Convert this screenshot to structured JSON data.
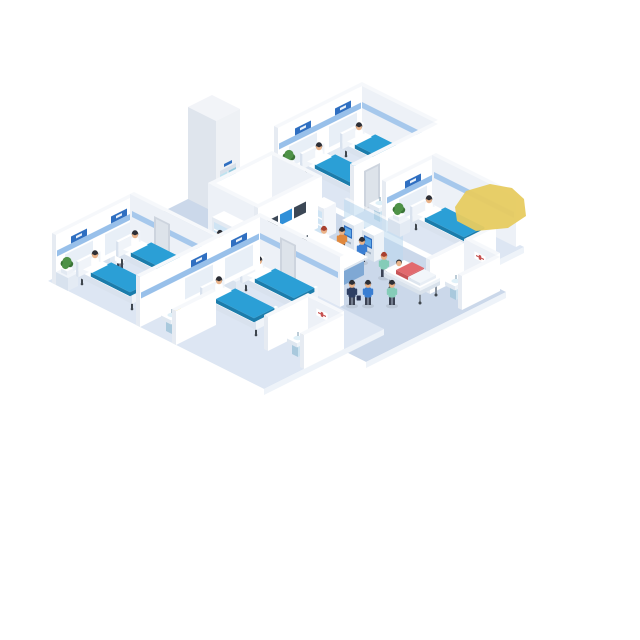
{
  "scene": {
    "title": "Isometric hospital ward illustration",
    "description": "Dollhouse-view hospital floor: four patient wards with blue beds and sitting patients, a single-bed ward, nurse reception desk with sign, control wall with monitors, elevator, two self-service kiosks with users, a stretcher pushed by a nurse, four small bathrooms with sinks and toilets, plants on bedside tables, and a yellow highlight marker at the upper right."
  },
  "labels": {
    "desk_sign": "护士站"
  },
  "colors": {
    "floor_room": "#dde6f3",
    "floor_corridor": "#cbd8ea",
    "floor_sw": "#ffffff",
    "floor_se": "#eef3f9",
    "wall_top": "#f6f8fb",
    "wall_sw": "#e6ebf2",
    "wall_se": "#ffffff",
    "wall_inner": "#edf1f7",
    "stripe": "#8db9e8",
    "sign": "#2f6fc1",
    "panel": "#e8eff7",
    "door": "#cdd4de",
    "door_inner": "#dde3ea",
    "bed_top": "#2b9fd6",
    "bed_side": "#1b7cab",
    "frame": "#ffffff",
    "frame_side": "#d9e2ee",
    "leg": "#3f464e",
    "pillow": "#ffffff",
    "table": "#f1f5fa",
    "table_side": "#d8e2ee",
    "pot": "#ffffff",
    "plant": "#4e9247",
    "plant_dark": "#3a7336",
    "desk_band": "#1d5ca8",
    "desk_body": "#a9c9e8",
    "desk_side": "#7fa8d4",
    "desk_top": "#ffffff",
    "glass": "#bcd9ee",
    "kiosk_body": "#eef3f8",
    "kiosk_side": "#d7e1ec",
    "kiosk_screen": "#2f6fc1",
    "monitor_dark": "#3c4856",
    "monitor_blue": "#2f8fd8",
    "monitor_frame": "#ffffff",
    "cab_glass": "#cfe4f4",
    "elev_top": "#f2f4f8",
    "elev_sw": "#dfe5ed",
    "elev_se": "#eef1f5",
    "elev_door": "#bfe2ef",
    "elev_door2": "#93c9de",
    "elev_lintel": "#d8e0ea",
    "gurney": "#f4f7fa",
    "gurney_side": "#d9e2ec",
    "sink": "#cde3f0",
    "sink_side": "#a9c9dd",
    "basin": "#dff0f8",
    "toilet": "#ffffff",
    "toilet_seat": "#e7c444",
    "skin": "#eab389",
    "hair_dark": "#2d2f36",
    "hair_red": "#a8402f",
    "outfit_white": "#ffffff",
    "outfit_blue": "#3a7ed2",
    "outfit_green": "#85ccb8",
    "outfit_orange": "#e0883d",
    "outfit_navy": "#2e3f63",
    "outfit_pink": "#e26a6e",
    "pants": "#3c4354",
    "art_red": "#c65050",
    "yellow": "#e7cb60"
  },
  "objects": [
    {
      "t": "floor",
      "n": "floor-corridor",
      "p": [
        -95,
        -25
      ],
      "q": [
        -6,
        120
      ],
      "tone": "corridor"
    },
    {
      "t": "floor",
      "n": "floor-ward-r1",
      "p": [
        -25,
        19
      ],
      "q": [
        0,
        44
      ],
      "tone": "room"
    },
    {
      "t": "floor",
      "n": "floor-ward-r2",
      "p": [
        -25,
        2
      ],
      "q": [
        44,
        102
      ],
      "tone": "room"
    },
    {
      "t": "floor",
      "n": "floor-ward-r3",
      "p": [
        -134,
        -95
      ],
      "q": [
        0,
        46
      ],
      "tone": "room"
    },
    {
      "t": "floor",
      "n": "floor-ward-r4",
      "p": [
        -134,
        -74
      ],
      "q": [
        46,
        108
      ],
      "tone": "room"
    },
    {
      "t": "wallQ",
      "n": "wall-r1-headboard",
      "p": [
        -25,
        17
      ],
      "q": 4,
      "h": 50,
      "stripe": true,
      "panels": [
        -12.5,
        7.5
      ],
      "signs": [
        -12.5,
        7.5
      ]
    },
    {
      "t": "wallP",
      "n": "wall-r1-side",
      "p": 17,
      "q": [
        4,
        42
      ],
      "h": 50,
      "stripe": true
    },
    {
      "t": "wallQ",
      "n": "wall-r1-partition",
      "p": [
        -25,
        17
      ],
      "q": 42,
      "h": 50,
      "door": [
        -20,
        -12
      ]
    },
    {
      "t": "wallP",
      "n": "wall-bath1-side",
      "p": -5,
      "q": [
        44,
        58
      ],
      "h": 34,
      "art": true
    },
    {
      "t": "wallQ",
      "n": "wall-r2-headboard",
      "p": [
        -25,
        0
      ],
      "q": 58,
      "h": 50,
      "stripe": true,
      "panels": [
        -11.5
      ],
      "signs": [
        -11.5
      ]
    },
    {
      "t": "wallP",
      "n": "wall-r2-side",
      "p": 0,
      "q": [
        58,
        100
      ],
      "h": 50,
      "stripe": true
    },
    {
      "t": "wallQ",
      "n": "wall-r2-end",
      "p": [
        -25,
        -12
      ],
      "q": 100,
      "h": 34
    },
    {
      "t": "wallQ",
      "n": "wall-bath2-back",
      "p": [
        -45,
        -28
      ],
      "q": 100,
      "h": 34
    },
    {
      "t": "wallP",
      "n": "wall-bath2-side",
      "p": -26,
      "q": [
        100,
        116
      ],
      "h": 34,
      "art": true
    },
    {
      "t": "wallQ",
      "n": "wall-bath2-front",
      "p": [
        -45,
        -26
      ],
      "q": 116,
      "h": 34
    },
    {
      "t": "wallQ",
      "n": "wall-control-back",
      "p": [
        -70,
        -40
      ],
      "q": 16,
      "h": 50
    },
    {
      "t": "wallP",
      "n": "wall-control-east",
      "p": -40,
      "q": [
        16,
        41
      ],
      "h": 50
    },
    {
      "t": "wallP",
      "n": "wall-control-west",
      "p": -70,
      "q": [
        16,
        41
      ],
      "h": 50
    },
    {
      "t": "wallQ",
      "n": "wall-control-monitors",
      "p": [
        -70,
        -40
      ],
      "q": 39,
      "h": 50,
      "monitors": true
    },
    {
      "t": "wallQ",
      "n": "wall-r3-headboard",
      "p": [
        -134,
        -95
      ],
      "q": 2,
      "h": 50,
      "stripe": true,
      "panels": [
        -122.5,
        -102.5
      ],
      "signs": [
        -122.5,
        -102.5
      ]
    },
    {
      "t": "wallP",
      "n": "wall-r3-side",
      "p": -95,
      "q": [
        2,
        44
      ],
      "h": 50,
      "stripe": true,
      "door": [
        14,
        22
      ]
    },
    {
      "t": "wallQ",
      "n": "wall-r4-headboard",
      "p": [
        -134,
        -74
      ],
      "q": 44,
      "h": 50,
      "stripe": true,
      "panels": [
        -104.5,
        -84.5
      ],
      "signs": [
        -104.5,
        -84.5
      ]
    },
    {
      "t": "wallP",
      "n": "wall-r4-side",
      "p": -74,
      "q": [
        44,
        86
      ],
      "h": 50,
      "stripe": true,
      "door": [
        56,
        64
      ]
    },
    {
      "t": "wallP",
      "n": "wall-bath3-side",
      "p": -114,
      "q": [
        46,
        62
      ],
      "h": 34,
      "art": true
    },
    {
      "t": "wallQ",
      "n": "wall-bath3-front",
      "p": [
        -134,
        -114
      ],
      "q": 62,
      "h": 34
    },
    {
      "t": "wallQ",
      "n": "wall-bath4-back",
      "p": [
        -114,
        -94
      ],
      "q": 88,
      "h": 34
    },
    {
      "t": "wallP",
      "n": "wall-bath4-side",
      "p": -94,
      "q": [
        88,
        106
      ],
      "h": 34,
      "art": true
    },
    {
      "t": "wallQ",
      "n": "wall-bath4-front",
      "p": [
        -114,
        -94
      ],
      "q": 106,
      "h": 34
    },
    {
      "t": "glass",
      "n": "wall-kiosk-glass",
      "p": -38,
      "q": [
        52,
        80
      ],
      "h": 38,
      "k": 90
    },
    {
      "t": "elevator",
      "n": "elevator",
      "p": [
        -58,
        -46
      ],
      "q": [
        -6,
        8
      ]
    },
    {
      "t": "cabinet",
      "n": "supply-cabinet",
      "p": [
        -76,
        -70
      ],
      "q": [
        24,
        34
      ],
      "k": 112
    },
    {
      "t": "cabinet",
      "n": "medicine-cabinet",
      "p": [
        -44,
        -38
      ],
      "q": [
        42,
        48
      ]
    },
    {
      "t": "desk",
      "n": "reception-desk",
      "p": [
        -68,
        -52
      ],
      "q": [
        50,
        76
      ]
    },
    {
      "t": "kiosk",
      "n": "self-service-kiosk-1",
      "p": [
        -43,
        -38
      ],
      "q": [
        56,
        62
      ]
    },
    {
      "t": "kiosk",
      "n": "self-service-kiosk-2",
      "p": [
        -43,
        -38
      ],
      "q": [
        66,
        72
      ]
    },
    {
      "t": "gurney",
      "n": "stretcher-bed",
      "p": [
        -54,
        -42
      ],
      "q": [
        86,
        106
      ]
    },
    {
      "t": "bed",
      "n": "bed-r1-a",
      "p": [
        -18,
        -7
      ],
      "q": [
        10,
        38
      ]
    },
    {
      "t": "bed",
      "n": "bed-r1-b",
      "p": [
        2,
        13
      ],
      "q": [
        10,
        38
      ]
    },
    {
      "t": "bed",
      "n": "bed-r2",
      "p": [
        -17,
        -6
      ],
      "q": [
        64,
        92
      ]
    },
    {
      "t": "bed",
      "n": "bed-r3-a",
      "p": [
        -128,
        -117
      ],
      "q": [
        8,
        36
      ]
    },
    {
      "t": "bed",
      "n": "bed-r3-b",
      "p": [
        -108,
        -97
      ],
      "q": [
        8,
        36
      ]
    },
    {
      "t": "bed",
      "n": "bed-r4-a",
      "p": [
        -110,
        -99
      ],
      "q": [
        52,
        80
      ]
    },
    {
      "t": "bed",
      "n": "bed-r4-b",
      "p": [
        -90,
        -79
      ],
      "q": [
        52,
        80
      ]
    },
    {
      "t": "plantTable",
      "n": "bedside-plant",
      "p": [
        -25,
        -20
      ],
      "q": [
        6,
        12
      ]
    },
    {
      "t": "plantTable",
      "n": "bedside-plant",
      "p": [
        -5,
        0
      ],
      "q": [
        6,
        12
      ]
    },
    {
      "t": "plantTable",
      "n": "bedside-plant",
      "p": [
        -24,
        -19
      ],
      "q": [
        60,
        66
      ]
    },
    {
      "t": "plantTable",
      "n": "bedside-plant",
      "p": [
        -134,
        -129
      ],
      "q": [
        4,
        10
      ]
    },
    {
      "t": "plantTable",
      "n": "bedside-plant",
      "p": [
        -113,
        -108
      ],
      "q": [
        4,
        10
      ]
    },
    {
      "t": "plantTable",
      "n": "bedside-plant",
      "p": [
        -114,
        -109
      ],
      "q": [
        48,
        54
      ]
    },
    {
      "t": "plantTable",
      "n": "bedside-plant",
      "p": [
        -94,
        -89
      ],
      "q": [
        48,
        54
      ]
    },
    {
      "t": "sink",
      "n": "sink",
      "at": [
        -20,
        52
      ]
    },
    {
      "t": "toilet",
      "n": "toilet",
      "at": [
        -11,
        47
      ]
    },
    {
      "t": "sink",
      "n": "sink",
      "at": [
        -40,
        110
      ]
    },
    {
      "t": "toilet",
      "n": "toilet",
      "at": [
        -33,
        105
      ]
    },
    {
      "t": "sink",
      "n": "sink",
      "at": [
        -128,
        56
      ]
    },
    {
      "t": "toilet",
      "n": "toilet",
      "at": [
        -120,
        51
      ]
    },
    {
      "t": "sink",
      "n": "sink",
      "at": [
        -108,
        99
      ]
    },
    {
      "t": "toilet",
      "n": "toilet",
      "at": [
        -101,
        93
      ]
    },
    {
      "t": "person",
      "n": "nurse-r1",
      "at": [
        14,
        8
      ],
      "outfit": "white"
    },
    {
      "t": "patientSit",
      "n": "patient-r1-a",
      "at": [
        -12.5,
        14
      ],
      "k": 57
    },
    {
      "t": "patientSit",
      "n": "patient-r1-b",
      "at": [
        7.5,
        14
      ],
      "k": 37
    },
    {
      "t": "person",
      "n": "nurse-r2",
      "at": [
        -4,
        76
      ],
      "outfit": "white"
    },
    {
      "t": "patientSit",
      "n": "patient-r2",
      "at": [
        -11.5,
        68
      ],
      "k": 110
    },
    {
      "t": "person",
      "n": "nurse-r3",
      "at": [
        -111,
        13
      ],
      "outfit": "white"
    },
    {
      "t": "patientSit",
      "n": "patient-r3-a",
      "at": [
        -122.5,
        12
      ],
      "k": 165
    },
    {
      "t": "patientSit",
      "n": "patient-r3-b",
      "at": [
        -102.5,
        12
      ],
      "k": 145
    },
    {
      "t": "person",
      "n": "nurse-r4",
      "at": [
        -77,
        50
      ],
      "outfit": "white"
    },
    {
      "t": "patientSit",
      "n": "patient-r4-a",
      "at": [
        -104.5,
        56
      ],
      "k": 191
    },
    {
      "t": "patientSit",
      "n": "patient-r4-b",
      "at": [
        -84.5,
        56
      ],
      "k": 171
    },
    {
      "t": "person",
      "n": "receptionist",
      "at": [
        -50,
        54
      ],
      "outfit": "white",
      "hair": "red"
    },
    {
      "t": "person",
      "n": "doctor-station",
      "at": [
        -78,
        30
      ],
      "outfit": "white",
      "k": 113
    },
    {
      "t": "person",
      "n": "doctor-elevator",
      "at": [
        -52,
        11
      ],
      "outfit": "white",
      "k": 67
    },
    {
      "t": "person",
      "n": "kiosk-user-1",
      "at": [
        -46,
        59
      ],
      "outfit": "orange",
      "k": 106
    },
    {
      "t": "person",
      "n": "kiosk-user-2",
      "at": [
        -46,
        69
      ],
      "outfit": "blue",
      "k": 116
    },
    {
      "t": "person",
      "n": "visitor-walking",
      "at": [
        -70,
        88
      ],
      "outfit": "navy",
      "case": true
    },
    {
      "t": "person",
      "n": "staff-walking",
      "at": [
        -66,
        92
      ],
      "outfit": "blue"
    },
    {
      "t": "person",
      "n": "nurse-gurney",
      "at": [
        -48,
        82
      ],
      "outfit": "green",
      "hair": "red"
    },
    {
      "t": "person",
      "n": "nurse-walking",
      "at": [
        -60,
        98
      ],
      "outfit": "green",
      "k": 161
    },
    {
      "t": "yellow",
      "n": "highlight-marker",
      "pts": [
        [
          455,
          207
        ],
        [
          466,
          191
        ],
        [
          490,
          184
        ],
        [
          512,
          188
        ],
        [
          524,
          199
        ],
        [
          526,
          216
        ],
        [
          508,
          228
        ],
        [
          476,
          231
        ],
        [
          457,
          221
        ]
      ],
      "k": 999
    }
  ]
}
